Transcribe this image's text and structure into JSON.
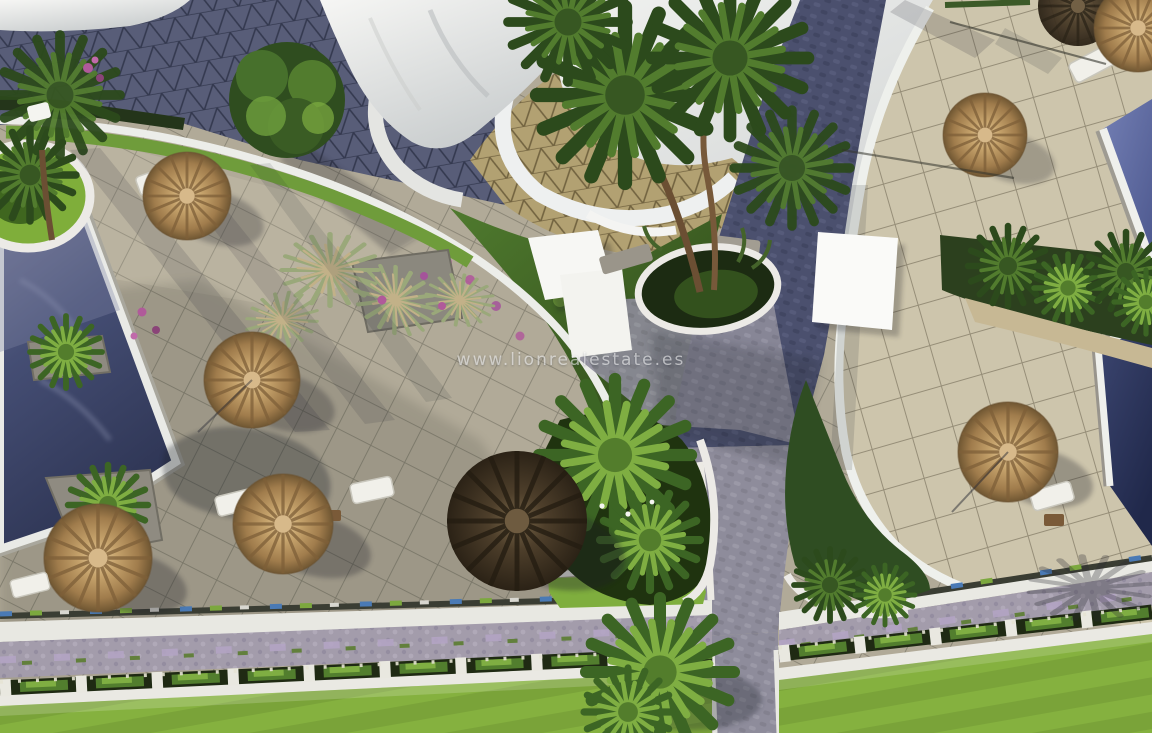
{
  "watermark": {
    "text": "www.lionrealestate.es"
  },
  "palette": {
    "trim_white": "#efefeb",
    "roof_white": "#f2f3f1",
    "sky_gray": "#d4d6d5",
    "left_plaza_tile": "#b1aa98",
    "right_plaza_tile": "#cdc5ac",
    "triangle_tile_tan": "#b2a172",
    "triangle_tile_dark": "#585d78",
    "road_cobble_dark": "#4f5472",
    "road_cobble_light": "#8e8c9b",
    "pool_dark_blue": "#39426a",
    "pool_light_blue": "#6b77ae",
    "pool_vivid_blue": "#2843a5",
    "lawn_green": "#7aa339",
    "foliage_dark": "#2f4d1f",
    "foliage_light": "#7fae42",
    "thatch_tan": "#b4925e",
    "thatch_dark": "#4a3d2a",
    "gravel_lavender": "#a39cab",
    "flower_magenta": "#b05a9a",
    "accent_blue": "#4a7ab5",
    "accent_green": "#7ca83e"
  }
}
